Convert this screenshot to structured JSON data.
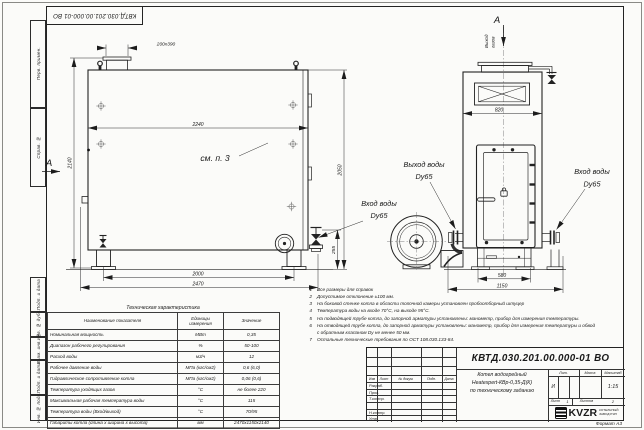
{
  "frame": {
    "stamp_top": "КВТД.030.201.00.000-01 ВО",
    "format_note": "Формат А3",
    "margin_labels": [
      "Перв. примен.",
      "Справ. №",
      "Подп. и дата",
      "Инв. № дубл.",
      "Взам. инв. №",
      "Подп. и дата",
      "Инв. № подл."
    ]
  },
  "drawing": {
    "section_label": "А",
    "gas_out_line1": "Выход",
    "gas_out_line2": "газов",
    "see_ref": "см. п. 3",
    "dim_stub": "200x390",
    "dim_front_width": "2240",
    "dim_front_height": "2140",
    "dim_side_height": "2050",
    "dim_base_span": "2000",
    "dim_base_overall": "2470",
    "dim_valve_height": "255",
    "dim_side_width": "820",
    "dim_side_base": "580",
    "dim_side_overall": "1150",
    "label_water_out": "Выход воды",
    "label_water_out_dn": "Dy65",
    "label_water_in_side": "Вход воды",
    "label_water_in_side_dn": "Dy65",
    "label_water_in_front": "Вход воды",
    "label_water_in_front_dn": "Dy65"
  },
  "tech_table": {
    "title": "Техническая характеристика",
    "headers": [
      "Наименование показателя",
      "Единицы измерения",
      "Значение"
    ],
    "rows": [
      {
        "name": "Номинальная мощность",
        "unit": "МВт",
        "value": "0,35"
      },
      {
        "name": "Диапазон рабочего регулирования",
        "unit": "%",
        "value": "50-100"
      },
      {
        "name": "Расход воды",
        "unit": "м3/ч",
        "value": "12"
      },
      {
        "name": "Рабочее давление воды",
        "unit": "МПа (кгс/см2)",
        "value": "0,6 (6,0)"
      },
      {
        "name": "Гидравлическое сопротивление котла",
        "unit": "МПа (кгс/см2)",
        "value": "0,06 (0,6)"
      },
      {
        "name": "Температура уходящих газов",
        "unit": "°С",
        "value": "не более 220"
      },
      {
        "name": "Максимальная рабочая температура воды",
        "unit": "°С",
        "value": "115"
      },
      {
        "name": "Температура воды (Вход/выход)",
        "unit": "°С",
        "value": "70/95"
      },
      {
        "name": "Габариты котла (длина х ширина х высота)",
        "unit": "мм",
        "value": "2470х1150х2140"
      }
    ]
  },
  "notes": [
    {
      "num": "1",
      "text": "Все размеры для справок"
    },
    {
      "num": "2",
      "text": "Допустимое отклонение ±100 мм."
    },
    {
      "num": "3",
      "text": "На боковой стенке котла в области топочной камеры установлен пробоотборный штуцер"
    },
    {
      "num": "4",
      "text": "Температура воды на входе 70°С, на выходе 95°С."
    },
    {
      "num": "5",
      "text": "На подводящей трубе котла, до запорной арматуры установлены: манометр, прибор для измерения температуры."
    },
    {
      "num": "6",
      "text": "На отводящей трубе котла, до запорной арматуры установлены: манометр, прибор для измерения температуры и обвод",
      "text2": "с обратным клапаном Dу не менее 50 мм."
    },
    {
      "num": "7",
      "text": "Остальные технические требования по ОСТ 108.030.133-84."
    }
  ],
  "title_block": {
    "doc_number": "КВТД.030.201.00.000-01 ВО",
    "product_line1": "Котел водогрейный",
    "product_line2": "Heatexpert-КВр-0,35-Д(К)",
    "product_line3": "по техническому заданию",
    "col_izm": "Изм",
    "col_list": "Лист",
    "col_doc": "№ докум.",
    "col_sign": "Подп.",
    "col_date": "Дата",
    "row_developed": "Разраб.",
    "row_checked": "Пров.",
    "row_tcontrol": "Т.контр.",
    "row_ncontrol": "Н.контр.",
    "row_approved": "Утв.",
    "lit_label": "Лит.",
    "mass_label": "Масса",
    "scale_label": "Масштаб",
    "lit_value": "И",
    "scale_value": "1:15",
    "sheet_label": "Лист",
    "sheet_value": "1",
    "sheets_label": "Листов",
    "sheets_value": "2",
    "logo_text": "KVZR",
    "logo_line1": "КОТЕЛЬНЫЙ",
    "logo_line2": "ЗАВОД РЭП"
  }
}
